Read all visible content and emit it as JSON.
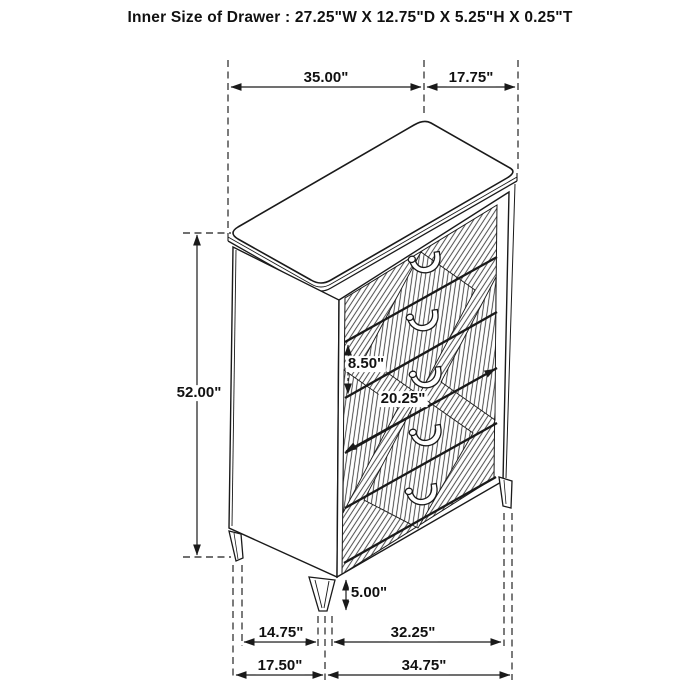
{
  "title": "Inner Size of Drawer : 27.25\"W X 12.75\"D X 5.25\"H X 0.25\"T",
  "dimensions": {
    "top_width": "35.00\"",
    "top_depth": "17.75\"",
    "overall_height": "52.00\"",
    "drawer_front_height": "8.50\"",
    "drawer_face_diagonal": "20.25\"",
    "leg_height": "5.00\"",
    "leg_inset_depth": "14.75\"",
    "leg_span_width": "32.25\"",
    "base_depth": "17.50\"",
    "base_width": "34.75\""
  },
  "colors": {
    "line": "#1a1a1a",
    "background": "#ffffff"
  }
}
